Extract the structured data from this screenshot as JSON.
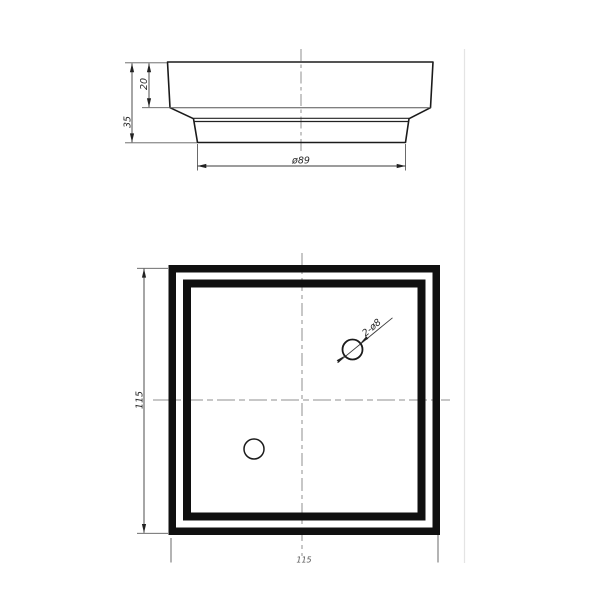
{
  "drawing": {
    "side_view": {
      "dim_total_height": "35",
      "dim_top_height": "20",
      "dim_base_diameter": "ø89"
    },
    "plan_view": {
      "dim_height": "115",
      "dim_width": "115",
      "hole_callout": "2-ø8"
    },
    "colors": {
      "line": "#1b1b1b",
      "thin_line": "#555555",
      "center_line": "#8f8f8f",
      "faint_line": "#e4e4e4",
      "background": "#ffffff"
    }
  }
}
